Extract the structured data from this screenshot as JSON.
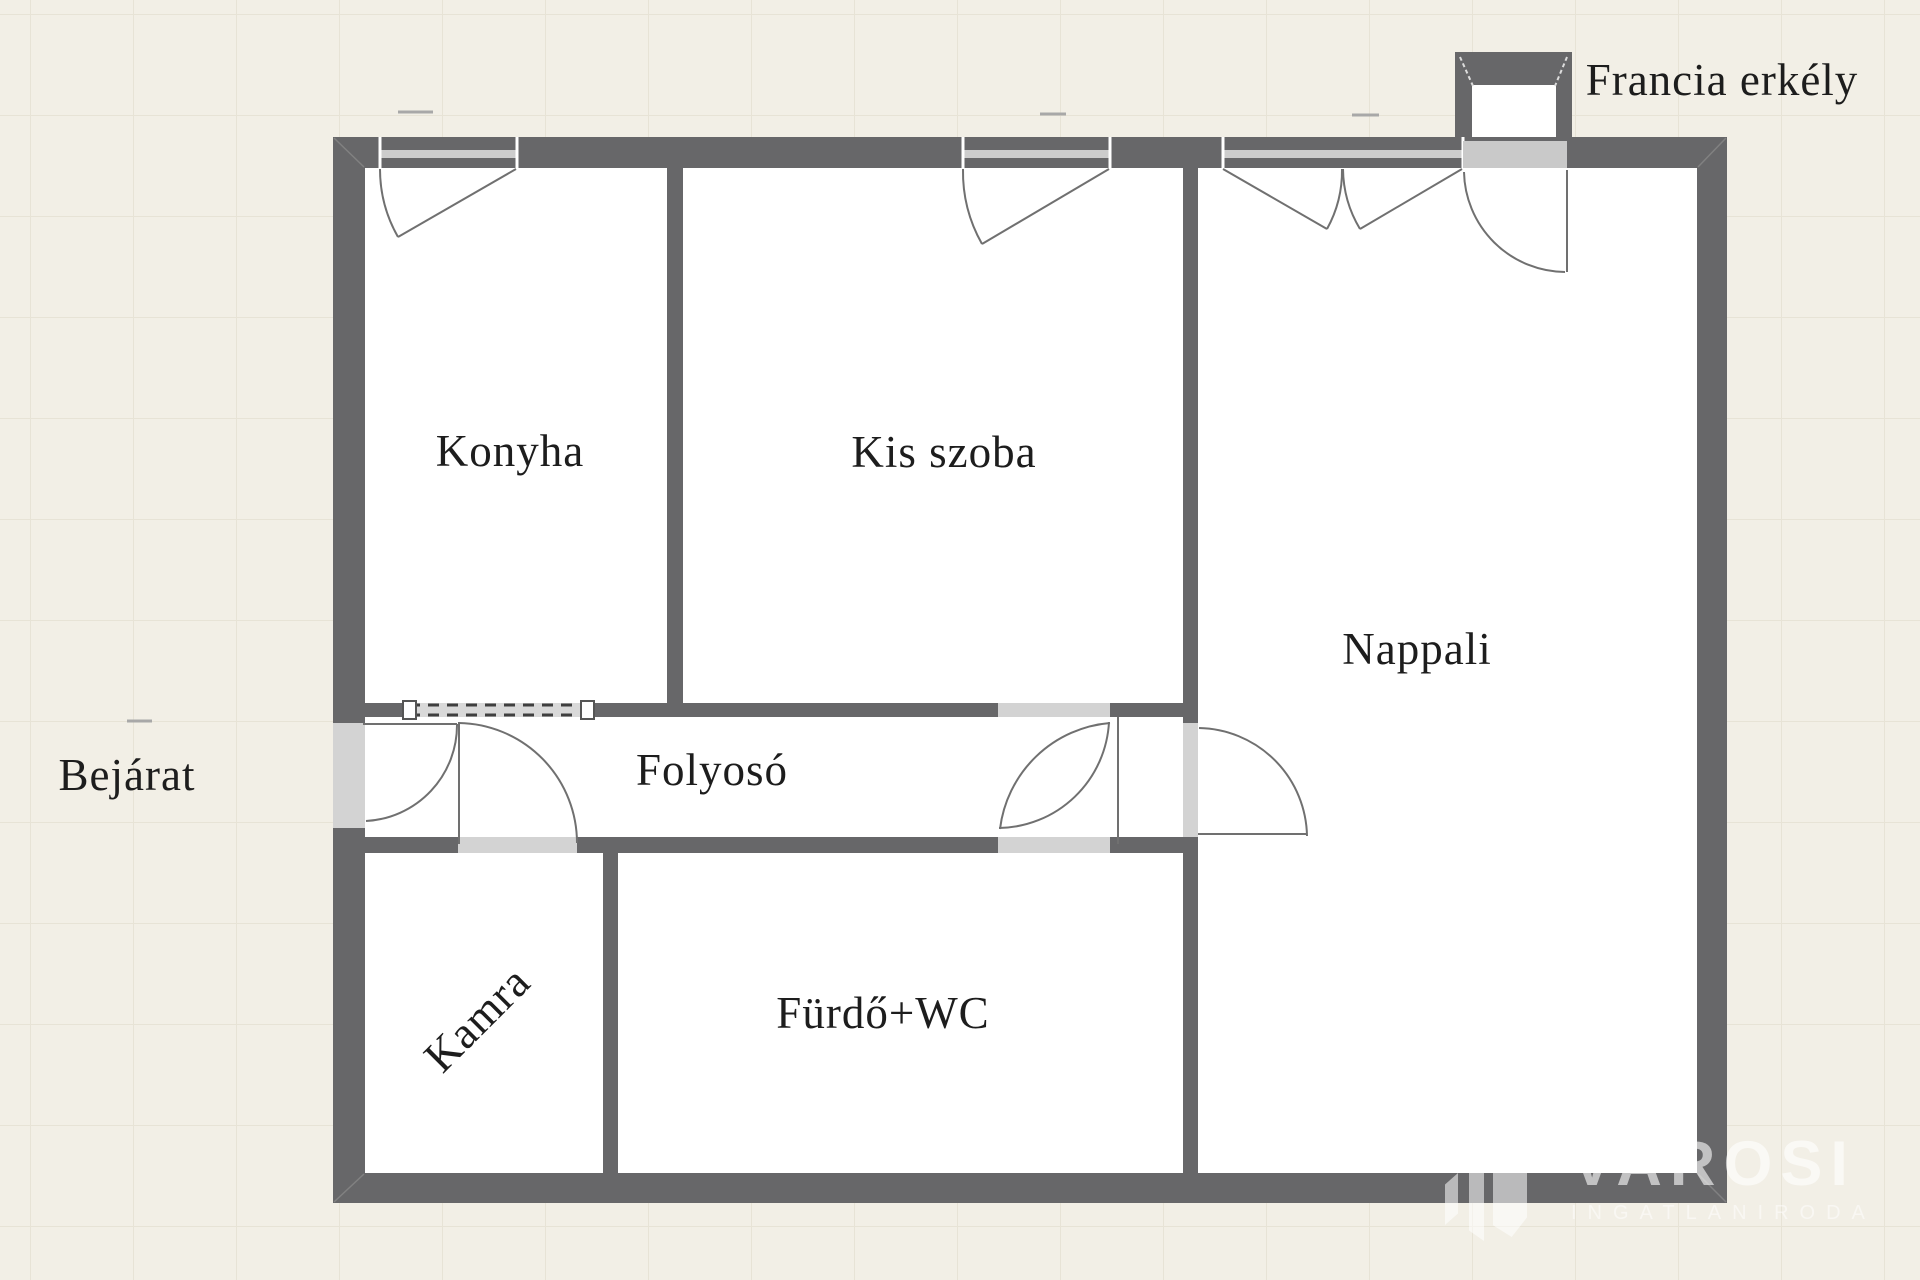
{
  "plan": {
    "rooms": {
      "konyha": "Konyha",
      "kis_szoba": "Kis szoba",
      "nappali": "Nappali",
      "folyoso": "Folyosó",
      "kamra": "Kamra",
      "furdo_wc": "Fürdő+WC"
    },
    "annotations": {
      "bejarat": "Bejárat",
      "francia_erkely": "Francia erkély"
    }
  },
  "watermark": {
    "brand": "VAROSI",
    "subtitle": "INGATLANIRODA"
  },
  "colors": {
    "wall": "#676769",
    "background": "#f2efe6",
    "grid_line": "#e7e3d6",
    "room_floor": "#ffffff",
    "opening_fill": "#d3d3d3",
    "window_glass": "#cccccc",
    "swing_line": "#707070",
    "label_text": "#1d1d1d",
    "watermark_text": "rgba(255,255,255,0.6)"
  }
}
